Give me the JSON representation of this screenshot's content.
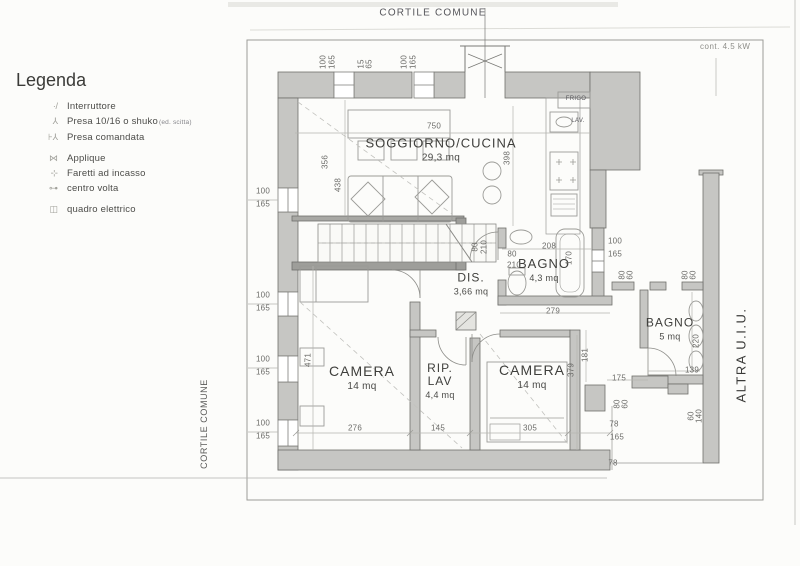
{
  "page": {
    "top_site_label": "CORTILE COMUNE",
    "left_site_label": "CORTILE COMUNE",
    "right_neighbor_label": "ALTRA U.I.U.",
    "power_note": "cont. 4.5 kW"
  },
  "legend": {
    "title": "Legenda",
    "items": [
      {
        "icon": "switch-icon",
        "label": "Interruttore"
      },
      {
        "icon": "socket-icon",
        "label": "Presa 10/16 o shuko",
        "suffix": "(ed. scitta)"
      },
      {
        "icon": "switched-socket-icon",
        "label": "Presa comandata"
      },
      {
        "icon": "sconce-icon",
        "label": "Applique",
        "gap_before": true
      },
      {
        "icon": "recessed-spotlight-icon",
        "label": "Faretti ad incasso"
      },
      {
        "icon": "ceiling-center-light-icon",
        "label": "centro volta"
      },
      {
        "icon": "electrical-panel-icon",
        "label": "quadro elettrico",
        "gap_before": true
      }
    ]
  },
  "rooms": [
    {
      "name": "SOGGIORNO/CUCINA",
      "area": "29,3 mq",
      "x": 441,
      "y": 150,
      "fs": 13,
      "afs": 10
    },
    {
      "name": "DIS.",
      "area": "3,66 mq",
      "x": 471,
      "y": 284,
      "fs": 12,
      "afs": 9
    },
    {
      "name": "BAGNO",
      "area": "4,3 mq",
      "x": 544,
      "y": 270,
      "fs": 13,
      "afs": 9
    },
    {
      "name": "CAMERA",
      "area": "14 mq",
      "x": 362,
      "y": 378,
      "fs": 14,
      "afs": 10
    },
    {
      "name": "RIP.\nLAV",
      "area": "4,4 mq",
      "x": 440,
      "y": 381,
      "fs": 12,
      "afs": 9
    },
    {
      "name": "CAMERA",
      "area": "14 mq",
      "x": 532,
      "y": 377,
      "fs": 14,
      "afs": 10
    },
    {
      "name": "BAGNO",
      "area": "5 mq",
      "x": 670,
      "y": 329,
      "fs": 12,
      "afs": 9
    }
  ],
  "fixtures": [
    {
      "label": "FRIGO",
      "x": 576,
      "y": 99
    },
    {
      "label": "LAV.",
      "x": 578,
      "y": 121
    }
  ],
  "dimensions": [
    {
      "v": "100",
      "x": 323,
      "y": 62,
      "r": 1
    },
    {
      "v": "165",
      "x": 332,
      "y": 62,
      "r": 1
    },
    {
      "v": "15",
      "x": 361,
      "y": 64,
      "r": 1
    },
    {
      "v": "65",
      "x": 369,
      "y": 64,
      "r": 1
    },
    {
      "v": "100",
      "x": 404,
      "y": 62,
      "r": 1
    },
    {
      "v": "165",
      "x": 413,
      "y": 62,
      "r": 1
    },
    {
      "v": "750",
      "x": 434,
      "y": 126,
      "r": 0
    },
    {
      "v": "356",
      "x": 325,
      "y": 162,
      "r": 1
    },
    {
      "v": "438",
      "x": 338,
      "y": 185,
      "r": 1
    },
    {
      "v": "398",
      "x": 507,
      "y": 158,
      "r": 1
    },
    {
      "v": "100",
      "x": 263,
      "y": 191,
      "r": 0
    },
    {
      "v": "165",
      "x": 263,
      "y": 204,
      "r": 0
    },
    {
      "v": "100",
      "x": 263,
      "y": 295,
      "r": 0
    },
    {
      "v": "165",
      "x": 263,
      "y": 308,
      "r": 0
    },
    {
      "v": "100",
      "x": 263,
      "y": 359,
      "r": 0
    },
    {
      "v": "165",
      "x": 263,
      "y": 372,
      "r": 0
    },
    {
      "v": "100",
      "x": 263,
      "y": 423,
      "r": 0
    },
    {
      "v": "165",
      "x": 263,
      "y": 436,
      "r": 0
    },
    {
      "v": "80",
      "x": 475,
      "y": 247,
      "r": 1
    },
    {
      "v": "210",
      "x": 484,
      "y": 247,
      "r": 1
    },
    {
      "v": "208",
      "x": 549,
      "y": 246,
      "r": 0
    },
    {
      "v": "80",
      "x": 512,
      "y": 254,
      "r": 0
    },
    {
      "v": "210",
      "x": 514,
      "y": 265,
      "r": 0
    },
    {
      "v": "170",
      "x": 569,
      "y": 258,
      "r": 1
    },
    {
      "v": "100",
      "x": 615,
      "y": 241,
      "r": 0
    },
    {
      "v": "165",
      "x": 615,
      "y": 254,
      "r": 0
    },
    {
      "v": "279",
      "x": 553,
      "y": 311,
      "r": 0
    },
    {
      "v": "471",
      "x": 308,
      "y": 360,
      "r": 1
    },
    {
      "v": "276",
      "x": 355,
      "y": 428,
      "r": 0
    },
    {
      "v": "145",
      "x": 438,
      "y": 428,
      "r": 0
    },
    {
      "v": "305",
      "x": 530,
      "y": 428,
      "r": 0
    },
    {
      "v": "379",
      "x": 571,
      "y": 370,
      "r": 1
    },
    {
      "v": "181",
      "x": 585,
      "y": 355,
      "r": 1
    },
    {
      "v": "175",
      "x": 619,
      "y": 378,
      "r": 0
    },
    {
      "v": "139",
      "x": 692,
      "y": 370,
      "r": 0
    },
    {
      "v": "220",
      "x": 696,
      "y": 341,
      "r": 1
    },
    {
      "v": "80",
      "x": 622,
      "y": 275,
      "r": 1
    },
    {
      "v": "60",
      "x": 630,
      "y": 275,
      "r": 1
    },
    {
      "v": "80",
      "x": 685,
      "y": 275,
      "r": 1
    },
    {
      "v": "60",
      "x": 693,
      "y": 275,
      "r": 1
    },
    {
      "v": "80",
      "x": 617,
      "y": 404,
      "r": 1
    },
    {
      "v": "60",
      "x": 625,
      "y": 404,
      "r": 1
    },
    {
      "v": "60",
      "x": 691,
      "y": 416,
      "r": 1
    },
    {
      "v": "140",
      "x": 699,
      "y": 416,
      "r": 1
    },
    {
      "v": "78",
      "x": 614,
      "y": 424,
      "r": 0
    },
    {
      "v": "165",
      "x": 617,
      "y": 437,
      "r": 0
    },
    {
      "v": "78",
      "x": 613,
      "y": 463,
      "r": 0
    }
  ]
}
